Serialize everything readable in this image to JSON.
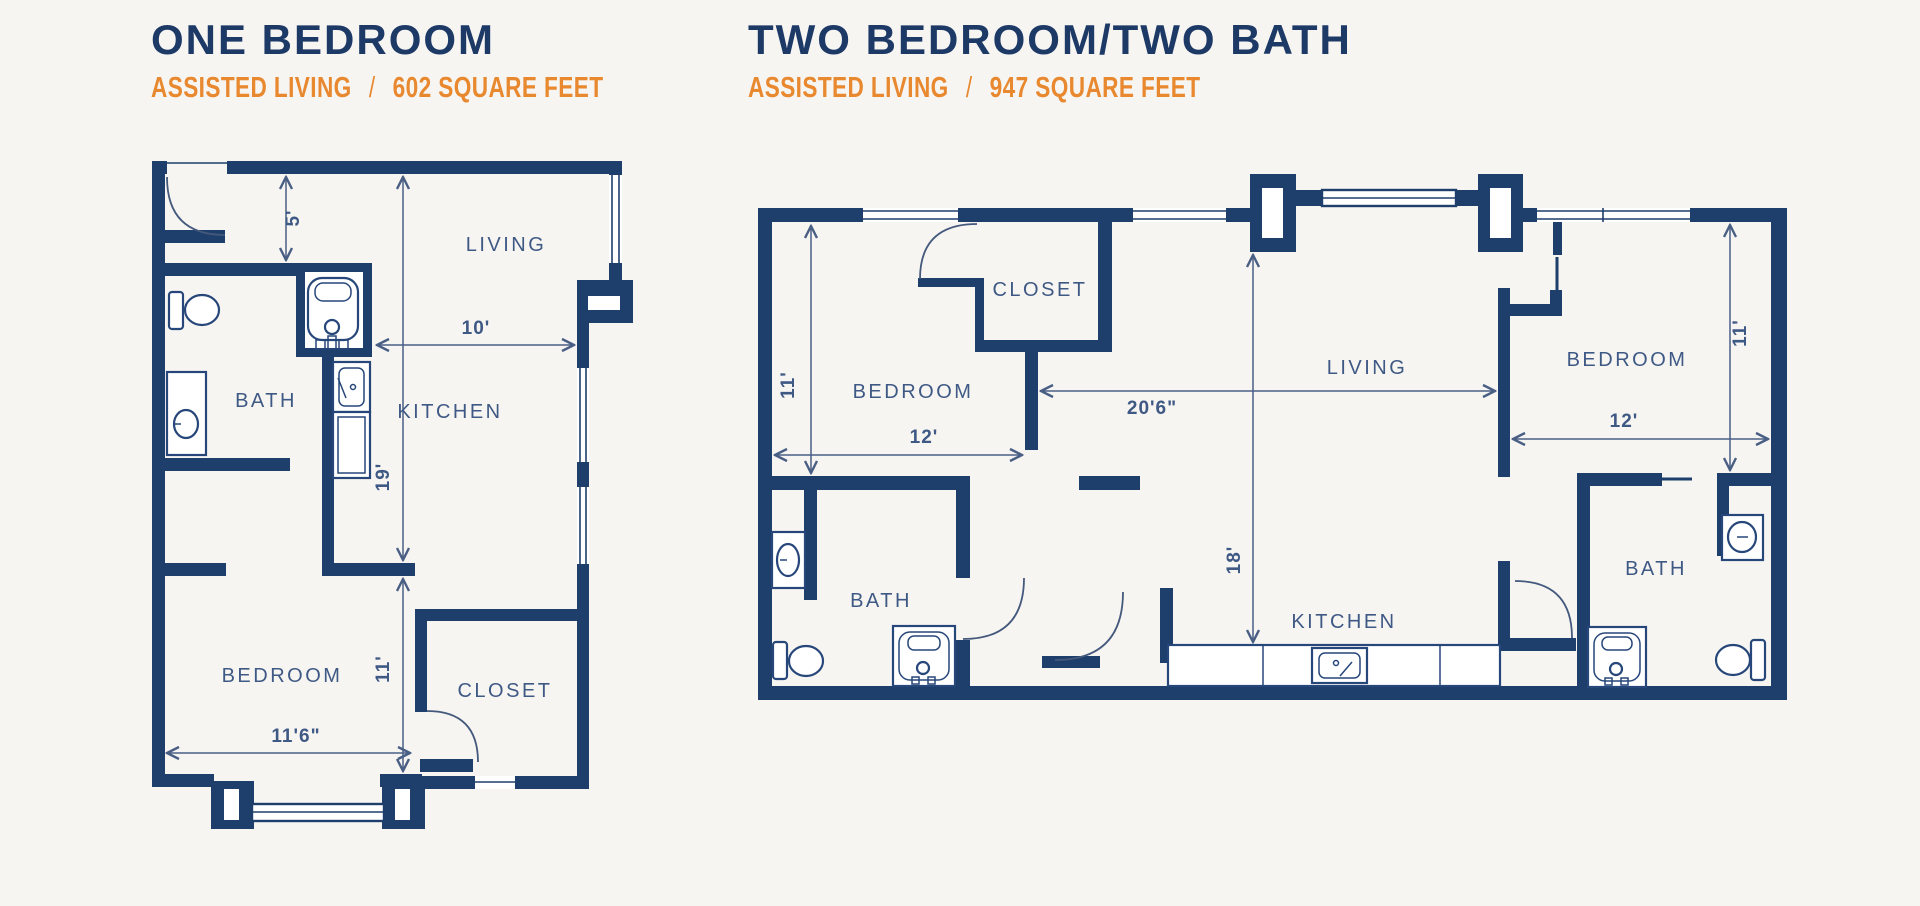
{
  "colors": {
    "background": "#f7f5f2",
    "wall_navy": "#1e3e6b",
    "title_navy": "#1d3a67",
    "accent_orange": "#e8882f",
    "label_blue": "#3f5985",
    "dim_line": "#4a5f84",
    "fixture_stroke": "#27477a"
  },
  "plans": [
    {
      "title": "ONE BEDROOM",
      "subtitle": {
        "type": "ASSISTED LIVING",
        "separator": "/",
        "size": "602 SQUARE FEET"
      },
      "rooms": {
        "living": "LIVING",
        "kitchen": "KITCHEN",
        "bath": "BATH",
        "bedroom": "BEDROOM",
        "closet": "CLOSET"
      },
      "dims": {
        "entry_depth": "5'",
        "kitchen_width": "10'",
        "main_depth": "19'",
        "bedroom_depth": "11'",
        "bedroom_width": "11'6\""
      }
    },
    {
      "title": "TWO BEDROOM/TWO BATH",
      "subtitle": {
        "type": "ASSISTED LIVING",
        "separator": "/",
        "size": "947 SQUARE FEET"
      },
      "rooms": {
        "bedroom_left": "BEDROOM",
        "closet": "CLOSET",
        "living": "LIVING",
        "bedroom_right": "BEDROOM",
        "bath_left": "BATH",
        "bath_right": "BATH",
        "kitchen": "KITCHEN"
      },
      "dims": {
        "bedroom_left_depth": "11'",
        "bedroom_left_width": "12'",
        "living_width": "20'6\"",
        "living_depth": "18'",
        "bedroom_right_depth": "11'",
        "bedroom_right_width": "12'"
      }
    }
  ]
}
